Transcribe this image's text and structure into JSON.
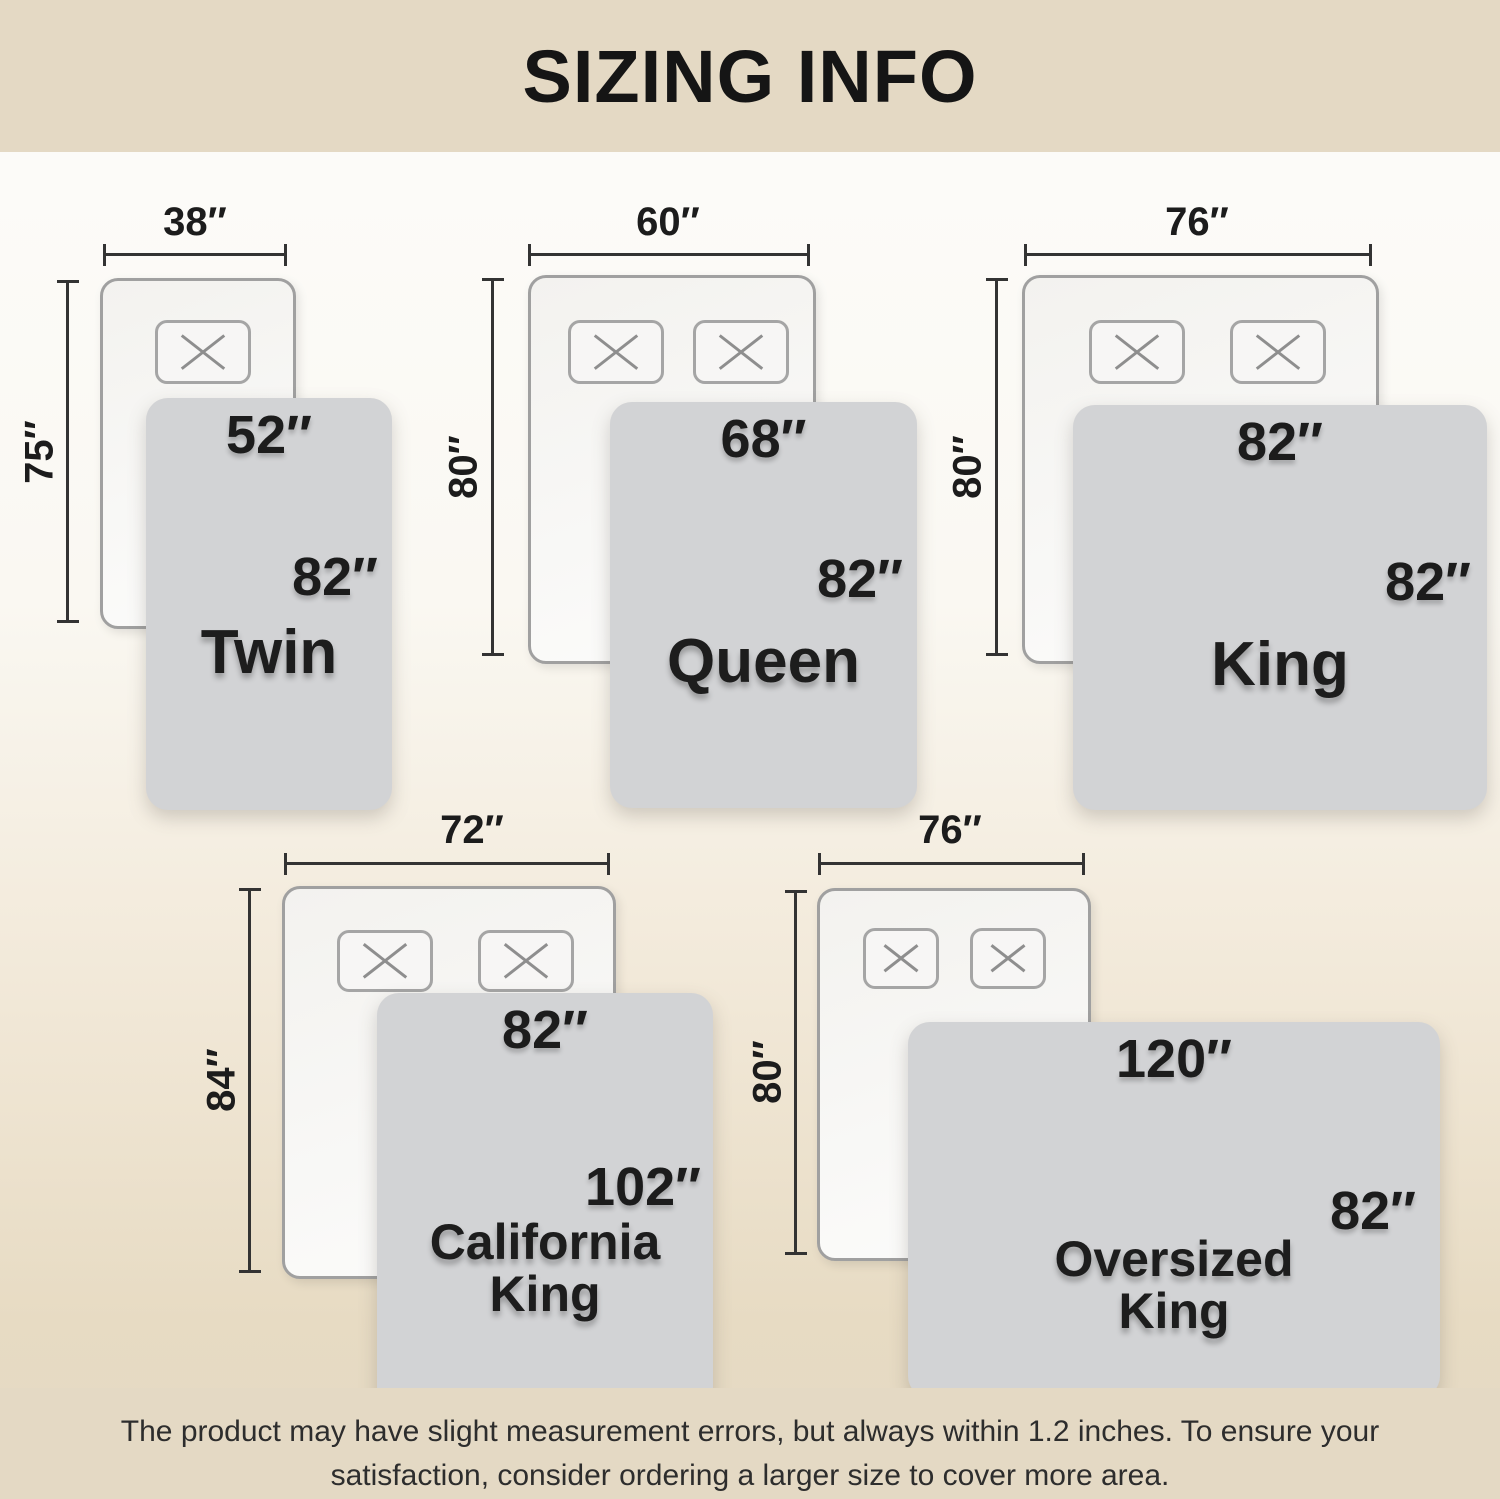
{
  "title": "SIZING INFO",
  "footer": {
    "line1": "The product may have slight measurement errors, but always within 1.2 inches. To ensure your",
    "line2": "satisfaction, consider ordering a larger size to cover more area."
  },
  "colors": {
    "band": "#e4d9c4",
    "background_top": "#fcfbf8",
    "background_bottom": "#e4d9c4",
    "blanket": "#d2d3d5",
    "mattress": "#f7f6f4",
    "dimension_line": "#333333",
    "text": "#1c1c1c"
  },
  "sizes": [
    {
      "id": "twin",
      "name": "Twin",
      "mattress_width": "38″",
      "mattress_length": "75″",
      "blanket_width": "52″",
      "blanket_length": "82″",
      "pillows": 1
    },
    {
      "id": "queen",
      "name": "Queen",
      "mattress_width": "60″",
      "mattress_length": "80″",
      "blanket_width": "68″",
      "blanket_length": "82″",
      "pillows": 2
    },
    {
      "id": "king",
      "name": "King",
      "mattress_width": "76″",
      "mattress_length": "80″",
      "blanket_width": "82″",
      "blanket_length": "82″",
      "pillows": 2
    },
    {
      "id": "california-king",
      "name_line1": "California",
      "name_line2": "King",
      "mattress_width": "72″",
      "mattress_length": "84″",
      "blanket_width": "82″",
      "blanket_length": "102″",
      "pillows": 2
    },
    {
      "id": "oversized-king",
      "name_line1": "Oversized",
      "name_line2": "King",
      "mattress_width": "76″",
      "mattress_length": "80″",
      "blanket_width": "120″",
      "blanket_length": "82″",
      "pillows": 2
    }
  ]
}
